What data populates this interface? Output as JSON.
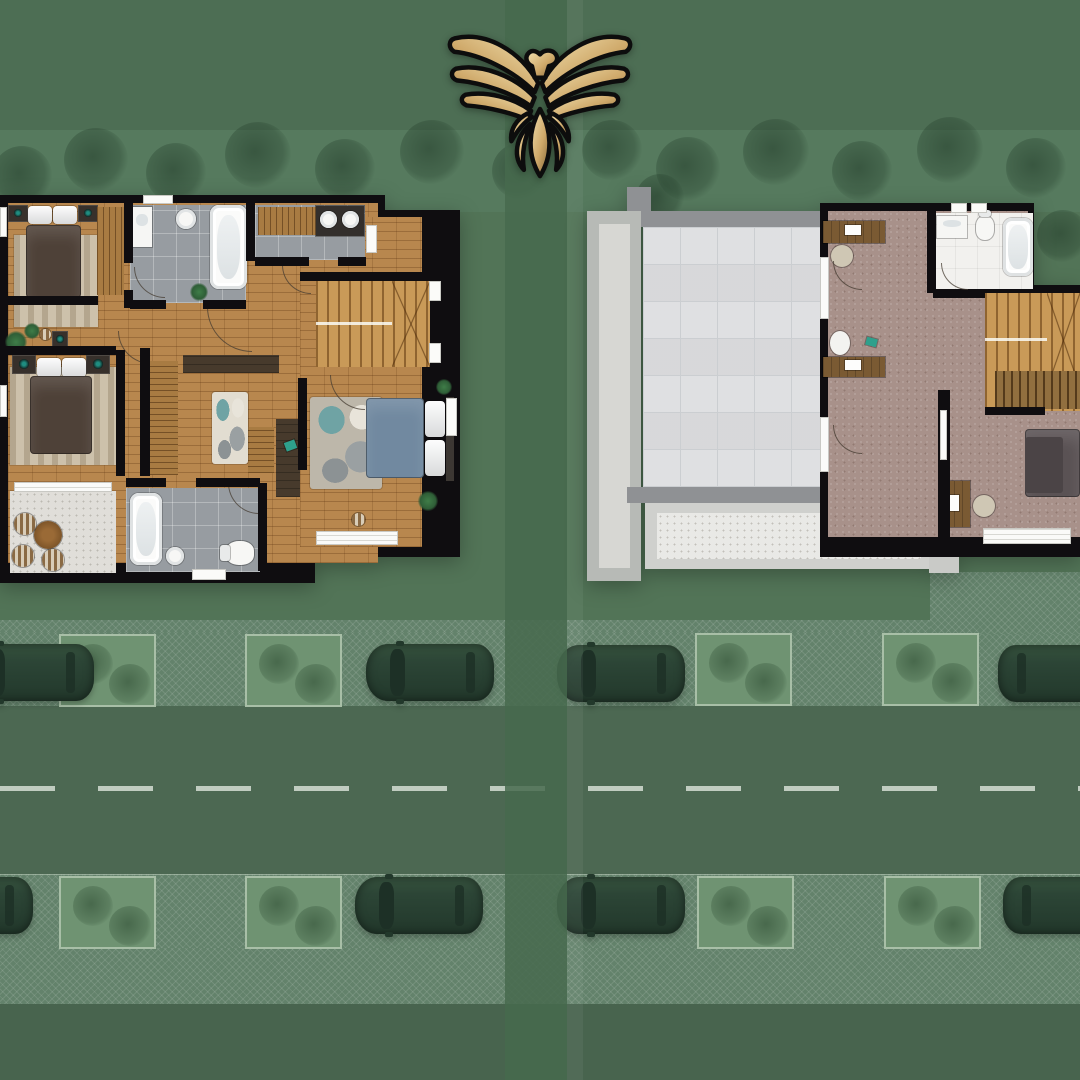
{
  "meta": {
    "description": "Aerial real-estate site rendering: two top-down villa floor plans side by side on a green landscaped street with parked cars, with a gold eagle emblem at top center",
    "logo_icon": "eagle-emblem"
  },
  "colors": {
    "bgTop": "#4d6e54",
    "bgTreeBand": "#567a5e",
    "bgGround": "#527457",
    "bgBottom": "#48644e",
    "divider": "#466a4d",
    "road": "#4c6852",
    "pave": "#63826b",
    "dash": "#d5ded4",
    "grassPlot": "#6f9372",
    "wall": "#0f0d10",
    "wood": "#b8874e",
    "tile": "#979ca1",
    "carpet": "#a8918a",
    "roofTile": "#e3e4e6",
    "roofGrout": "#cbced1",
    "parapet": "#8f9194",
    "pathOuter": "#b7bab6",
    "pathInner": "#d7d7d3",
    "stairWood": "#c99a58",
    "balconyFloor": "#e0ded9",
    "rug": "#cdc1ab",
    "duvetDark": "#4e4138",
    "duvetBlue": "#7189a0",
    "carBody": "#2c4536",
    "carGlass": "#1d3026",
    "carRoof": "#37543f",
    "gold1": "#f2e2b2",
    "gold2": "#7d6134",
    "logoOutline": "#0d0d0d"
  },
  "site": {
    "trees": [
      {
        "x": 22,
        "y": 176,
        "r": 30
      },
      {
        "x": 96,
        "y": 160,
        "r": 32
      },
      {
        "x": 176,
        "y": 173,
        "r": 30
      },
      {
        "x": 258,
        "y": 155,
        "r": 33
      },
      {
        "x": 345,
        "y": 169,
        "r": 30
      },
      {
        "x": 432,
        "y": 152,
        "r": 32
      },
      {
        "x": 520,
        "y": 171,
        "r": 28
      },
      {
        "x": 612,
        "y": 150,
        "r": 30
      },
      {
        "x": 688,
        "y": 169,
        "r": 32
      },
      {
        "x": 776,
        "y": 152,
        "r": 33
      },
      {
        "x": 862,
        "y": 171,
        "r": 30
      },
      {
        "x": 950,
        "y": 150,
        "r": 33
      },
      {
        "x": 1036,
        "y": 168,
        "r": 30
      },
      {
        "x": 1063,
        "y": 236,
        "r": 26
      },
      {
        "x": 660,
        "y": 198,
        "r": 24
      }
    ],
    "planters": [
      {
        "x": 59,
        "y": 634
      },
      {
        "x": 245,
        "y": 634
      },
      {
        "x": 695,
        "y": 633
      },
      {
        "x": 882,
        "y": 633
      },
      {
        "x": 59,
        "y": 876
      },
      {
        "x": 245,
        "y": 876
      },
      {
        "x": 697,
        "y": 876
      },
      {
        "x": 884,
        "y": 876
      }
    ],
    "cars": [
      {
        "x": -34,
        "y": 644,
        "flip": false
      },
      {
        "x": 366,
        "y": 644,
        "flip": false
      },
      {
        "x": 557,
        "y": 645,
        "flip": false
      },
      {
        "x": 998,
        "y": 645,
        "flip": true
      },
      {
        "x": -95,
        "y": 877,
        "flip": false
      },
      {
        "x": 355,
        "y": 877,
        "flip": false
      },
      {
        "x": 557,
        "y": 877,
        "flip": false
      },
      {
        "x": 1003,
        "y": 877,
        "flip": true
      }
    ]
  },
  "floorplans": {
    "left": {
      "id": "upper-floor-plan",
      "rooms": [
        "bedroom",
        "bathroom",
        "vanity-area",
        "hallway",
        "staircase",
        "master-bedroom",
        "walk-in-closet",
        "kids-bedroom",
        "bathroom",
        "balcony"
      ]
    },
    "right": {
      "id": "roof-floor-plan",
      "rooms": [
        "roof-terrace",
        "side-path",
        "study",
        "bathroom",
        "staircase",
        "bedroom",
        "lower-roof"
      ]
    }
  }
}
